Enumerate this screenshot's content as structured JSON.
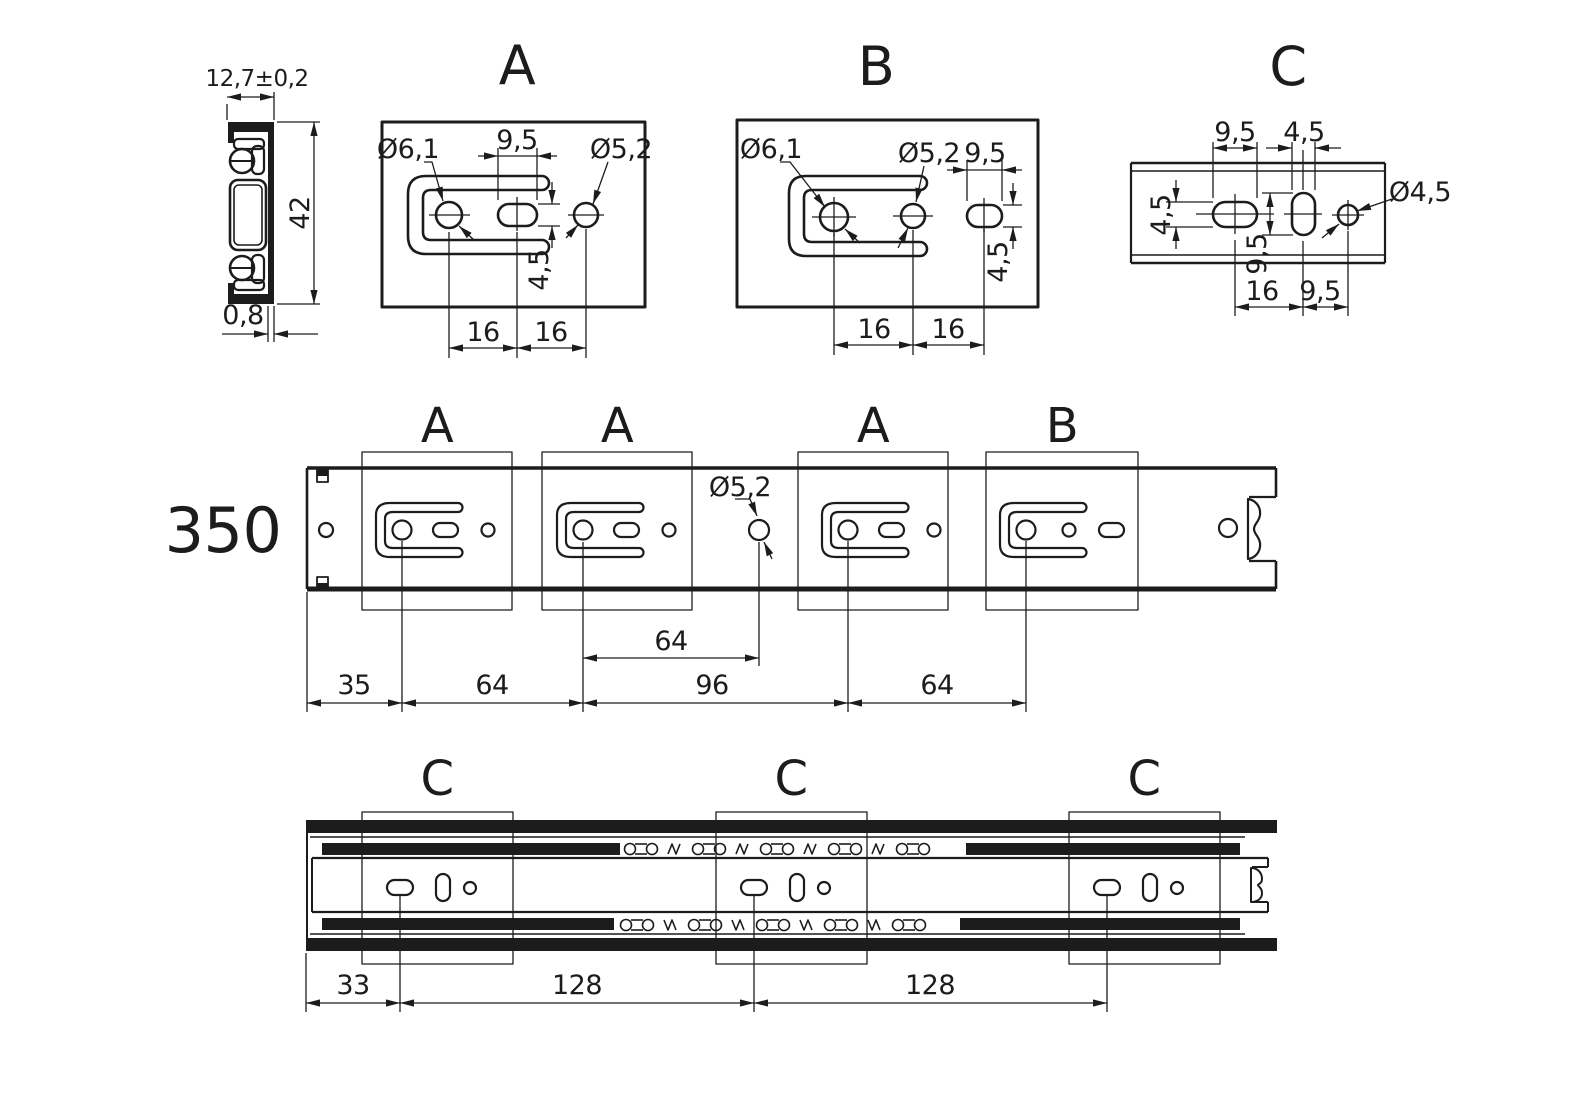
{
  "colors": {
    "ink": "#1c1c1c",
    "paper": "#ffffff"
  },
  "views": {
    "cross_section": {
      "dims": {
        "width": "12,7±0,2",
        "height": "42",
        "thickness": "0,8"
      }
    },
    "detail_A": {
      "title": "A",
      "labels": {
        "hole_large": "Ø6,1",
        "hole_small": "Ø5,2",
        "slot_width": "9,5",
        "slot_height": "4,5",
        "pitch_left": "16",
        "pitch_right": "16"
      }
    },
    "detail_B": {
      "title": "B",
      "labels": {
        "hole_large": "Ø6,1",
        "hole_small": "Ø5,2",
        "slot_width": "9,5",
        "slot_height": "4,5",
        "pitch_left": "16",
        "pitch_right": "16"
      }
    },
    "detail_C": {
      "title": "C",
      "labels": {
        "slot_width": "9,5",
        "oval_width": "4,5",
        "slot_height": "4,5",
        "oval_height": "9,5",
        "hole": "Ø4,5",
        "pitch_left": "16",
        "pitch_right": "9,5"
      }
    },
    "inner_rail": {
      "length": "350",
      "sections": [
        "A",
        "A",
        "A",
        "B"
      ],
      "free_hole": "Ø5,2",
      "dim_upper": "64",
      "dims": [
        "35",
        "64",
        "96",
        "64"
      ]
    },
    "assembled_rail": {
      "sections": [
        "C",
        "C",
        "C"
      ],
      "dims": [
        "33",
        "128",
        "128"
      ]
    }
  }
}
